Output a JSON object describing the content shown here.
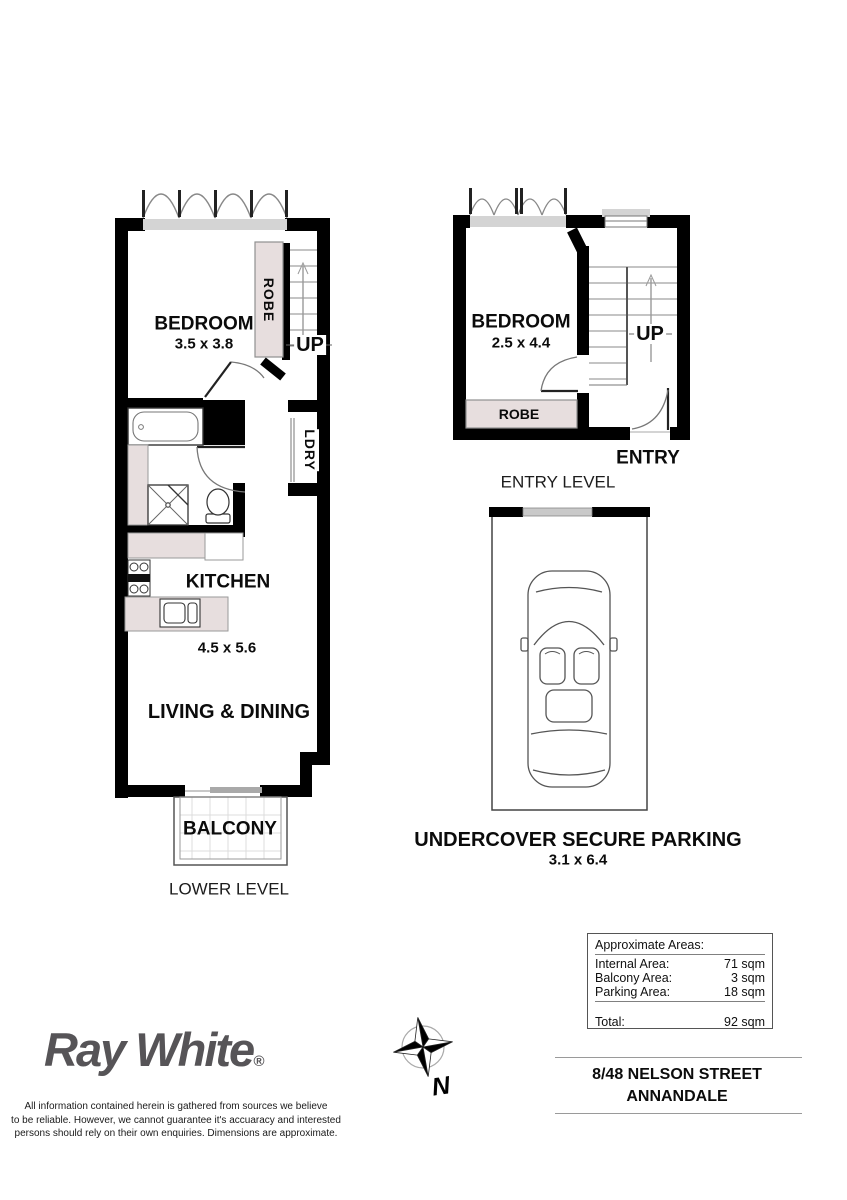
{
  "lower_plan": {
    "bedroom_label": "BEDROOM",
    "bedroom_dims": "3.5 x 3.8",
    "robe_label": "ROBE",
    "up_label": "UP",
    "ldry_label": "LDRY",
    "kitchen_label": "KITCHEN",
    "living_dims": "4.5 x 5.6",
    "living_label": "LIVING & DINING",
    "balcony_label": "BALCONY",
    "level_label": "LOWER LEVEL"
  },
  "entry_plan": {
    "bedroom_label": "BEDROOM",
    "bedroom_dims": "2.5 x 4.4",
    "robe_label": "ROBE",
    "up_label": "UP",
    "entry_label": "ENTRY",
    "level_label": "ENTRY LEVEL"
  },
  "parking": {
    "title": "UNDERCOVER SECURE PARKING",
    "dims": "3.1 x 6.4"
  },
  "areas": {
    "title": "Approximate Areas:",
    "rows": [
      {
        "label": "Internal Area:",
        "value": "71 sqm"
      },
      {
        "label": "Balcony Area:",
        "value": "3 sqm"
      },
      {
        "label": "Parking Area:",
        "value": "18 sqm"
      }
    ],
    "total_label": "Total:",
    "total_value": "92 sqm"
  },
  "address": {
    "line1": "8/48 NELSON STREET",
    "line2": "ANNANDALE"
  },
  "brand": {
    "name": "Ray White",
    "registered": "®"
  },
  "compass": {
    "north_label": "N"
  },
  "disclaimer": {
    "line1": "All information contained herein is gathered from sources we believe",
    "line2": "to be reliable. However, we cannot guarantee it's accuaracy and interested",
    "line3": "persons should rely on their own enquiries. Dimensions are approximate."
  },
  "colors": {
    "wall": "#000000",
    "fixture_shade": "#e7dede",
    "sill_gray": "#d4d4d4",
    "line_gray": "#888888",
    "logo_gray": "#565457"
  }
}
